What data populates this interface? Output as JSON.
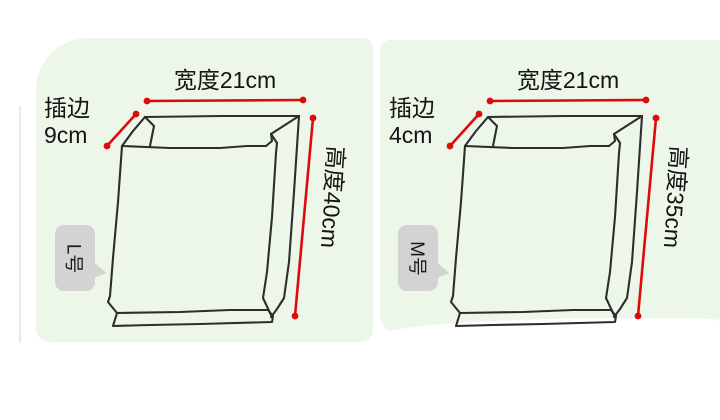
{
  "colors": {
    "panel_bg": "#edf7e9",
    "sketch": "#2d2d2d",
    "line_red": "#dd0b0b",
    "bubble_bg": "#d3d3d3",
    "text": "#141414",
    "page_bg": "#ffffff"
  },
  "diagrams": [
    {
      "name": "large-bag-diagram",
      "size_badge": "L号",
      "width_label": "宽度21cm",
      "gusset_label": "插边",
      "gusset_value": "9cm",
      "height_label": "高度40cm"
    },
    {
      "name": "medium-bag-diagram",
      "size_badge": "M号",
      "width_label": "宽度21cm",
      "gusset_label": "插边",
      "gusset_value": "4cm",
      "height_label": "高度35cm"
    }
  ]
}
